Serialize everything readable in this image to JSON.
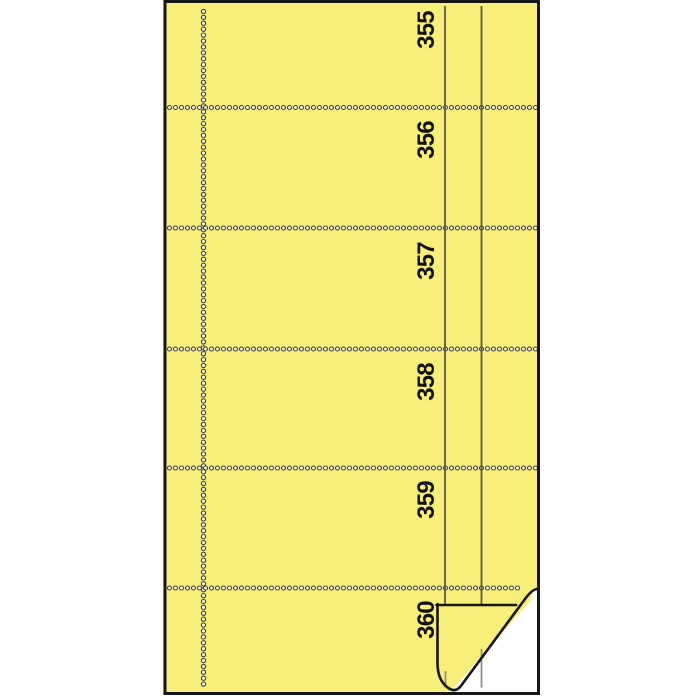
{
  "product_image": {
    "type": "numbered-receipt-book-sheet",
    "ticket_numbers": [
      "355",
      "356",
      "357",
      "358",
      "359",
      "360"
    ],
    "colors": {
      "background": "#FFFFFF",
      "paper": "#F8EE7A",
      "outline": "#161616",
      "perforation_ring": "#3E3E34",
      "perforation_fill": "#FBF8E4",
      "column_rule": "#57574D",
      "undersheet": "#FFFFFF",
      "undersheet_rule": "#8A8A8A",
      "number_text": "#121212"
    }
  }
}
